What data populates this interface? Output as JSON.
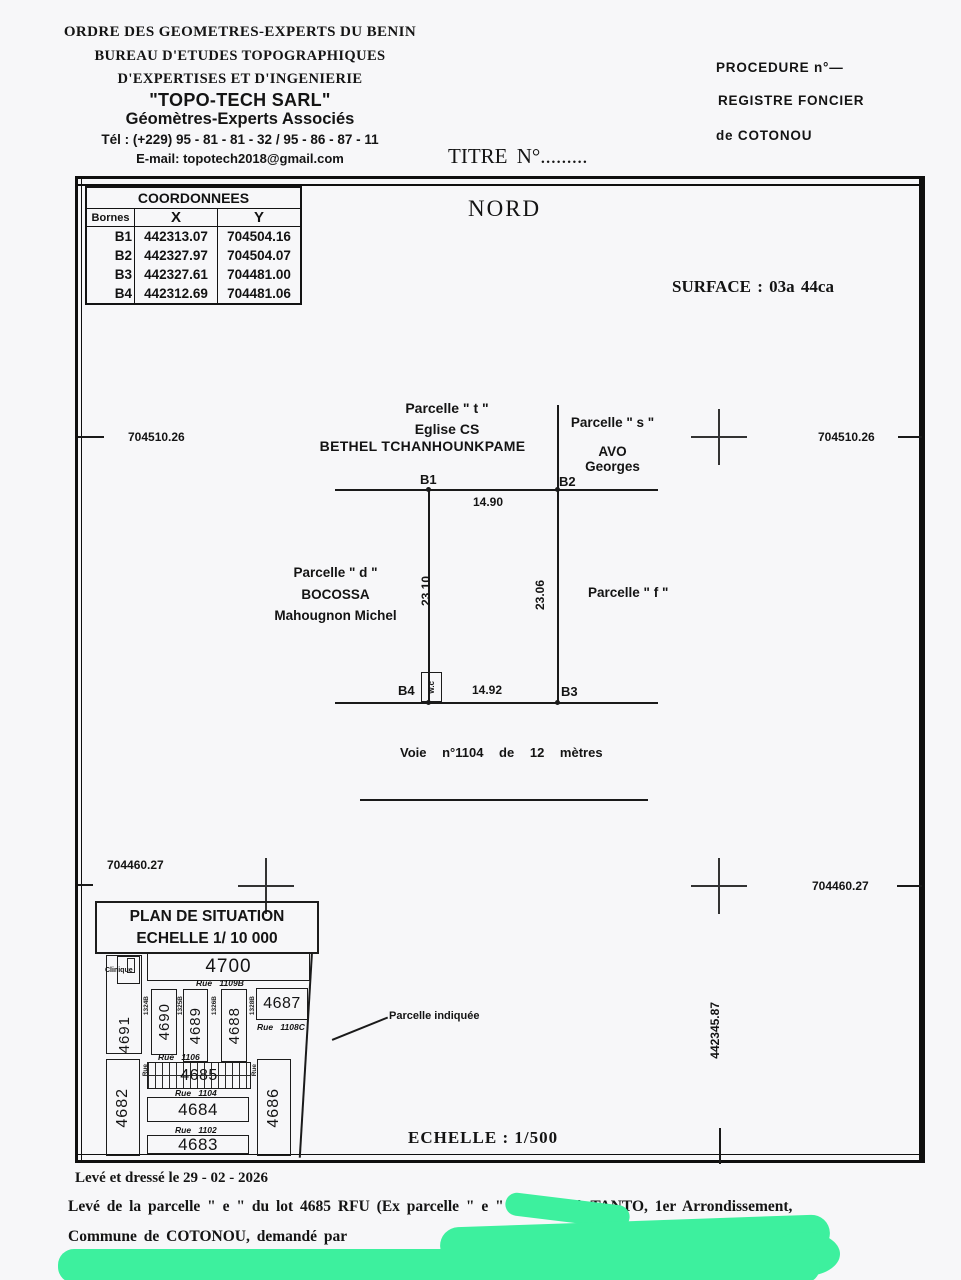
{
  "header": {
    "org1": "ORDRE DES GEOMETRES-EXPERTS DU BENIN",
    "org2": "BUREAU D'ETUDES TOPOGRAPHIQUES",
    "org3": "D'EXPERTISES ET D'INGENIERIE",
    "firm": "\"TOPO-TECH SARL\"",
    "firm_sub": "Géomètres-Experts Associés",
    "phone": "Tél : (+229) 95 - 81 - 81 - 32 / 95 - 86 - 87 - 11",
    "email": "E-mail: topotech2018@gmail.com",
    "procedure": "PROCEDURE  n°—",
    "register1": "REGISTRE FONCIER",
    "register2": "de COTONOU",
    "title_no": "TITRE  N°........."
  },
  "coords": {
    "title": "COORDONNEES",
    "col_bornes": "Bornes",
    "col_x": "X",
    "col_y": "Y",
    "rows": [
      {
        "b": "B1",
        "x": "442313.07",
        "y": "704504.16"
      },
      {
        "b": "B2",
        "x": "442327.97",
        "y": "704504.07"
      },
      {
        "b": "B3",
        "x": "442327.61",
        "y": "704481.00"
      },
      {
        "b": "B4",
        "x": "442312.69",
        "y": "704481.06"
      }
    ]
  },
  "north": "NORD",
  "surface": "SURFACE : 03a 44ca",
  "grid": {
    "top_left": "704510.26",
    "top_right": "704510.26",
    "bottom_left": "704460.27",
    "bottom_right": "704460.27",
    "east_vertical": "442345.87"
  },
  "plot": {
    "t1": "Parcelle \" t \"",
    "t2": "Eglise CS",
    "t3": "BETHEL  TCHANHOUNKPAME",
    "s1": "Parcelle \" s \"",
    "s2": "AVO",
    "s3": "Georges",
    "d1": "Parcelle \" d \"",
    "d2": "BOCOSSA",
    "d3": "Mahougnon Michel",
    "f1": "Parcelle \" f \"",
    "b1": "B1",
    "b2": "B2",
    "b3": "B3",
    "b4": "B4",
    "dim_top": "14.90",
    "dim_bottom": "14.92",
    "dim_left": "23.10",
    "dim_right": "23.06",
    "wc": "w.c",
    "road": "Voie n°1104 de 12 mètres"
  },
  "situation": {
    "title": "PLAN DE SITUATION",
    "scale": "ECHELLE 1/ 10 000",
    "clinic": "Clinique",
    "pointer": "Parcelle indiquée",
    "lots": {
      "l4700": "4700",
      "l4691": "4691",
      "l4690": "4690",
      "l4689": "4689",
      "l4688": "4688",
      "l4687": "4687",
      "l4686": "4686",
      "l4685": "4685",
      "l4684": "4684",
      "l4683": "4683",
      "l4682": "4682"
    },
    "streets": {
      "r1109": "Rue 1109B",
      "r1108": "Rue 1108C",
      "r1106": "Rue 1106",
      "r1104": "Rue 1104",
      "r1102": "Rue 1102"
    },
    "vstreets": {
      "v1": "1324B",
      "v2": "1325B",
      "v3": "1326B",
      "v4": "1328B",
      "v5": "Rue",
      "v6": "Rue"
    }
  },
  "scale_main": "ECHELLE : 1/500",
  "footer": {
    "dated": "Levé et dressé  le 29 - 02 - 2026",
    "line1": "Levé de la  parcelle \" e \" du lot 4685 RFU (Ex parcelle \" e \" 685) sise à TANTO, 1er Arrondissement,",
    "line2": "Commune de COTONOU, demandé par"
  },
  "colors": {
    "redaction": "#3DF09E",
    "ink": "#141414"
  }
}
